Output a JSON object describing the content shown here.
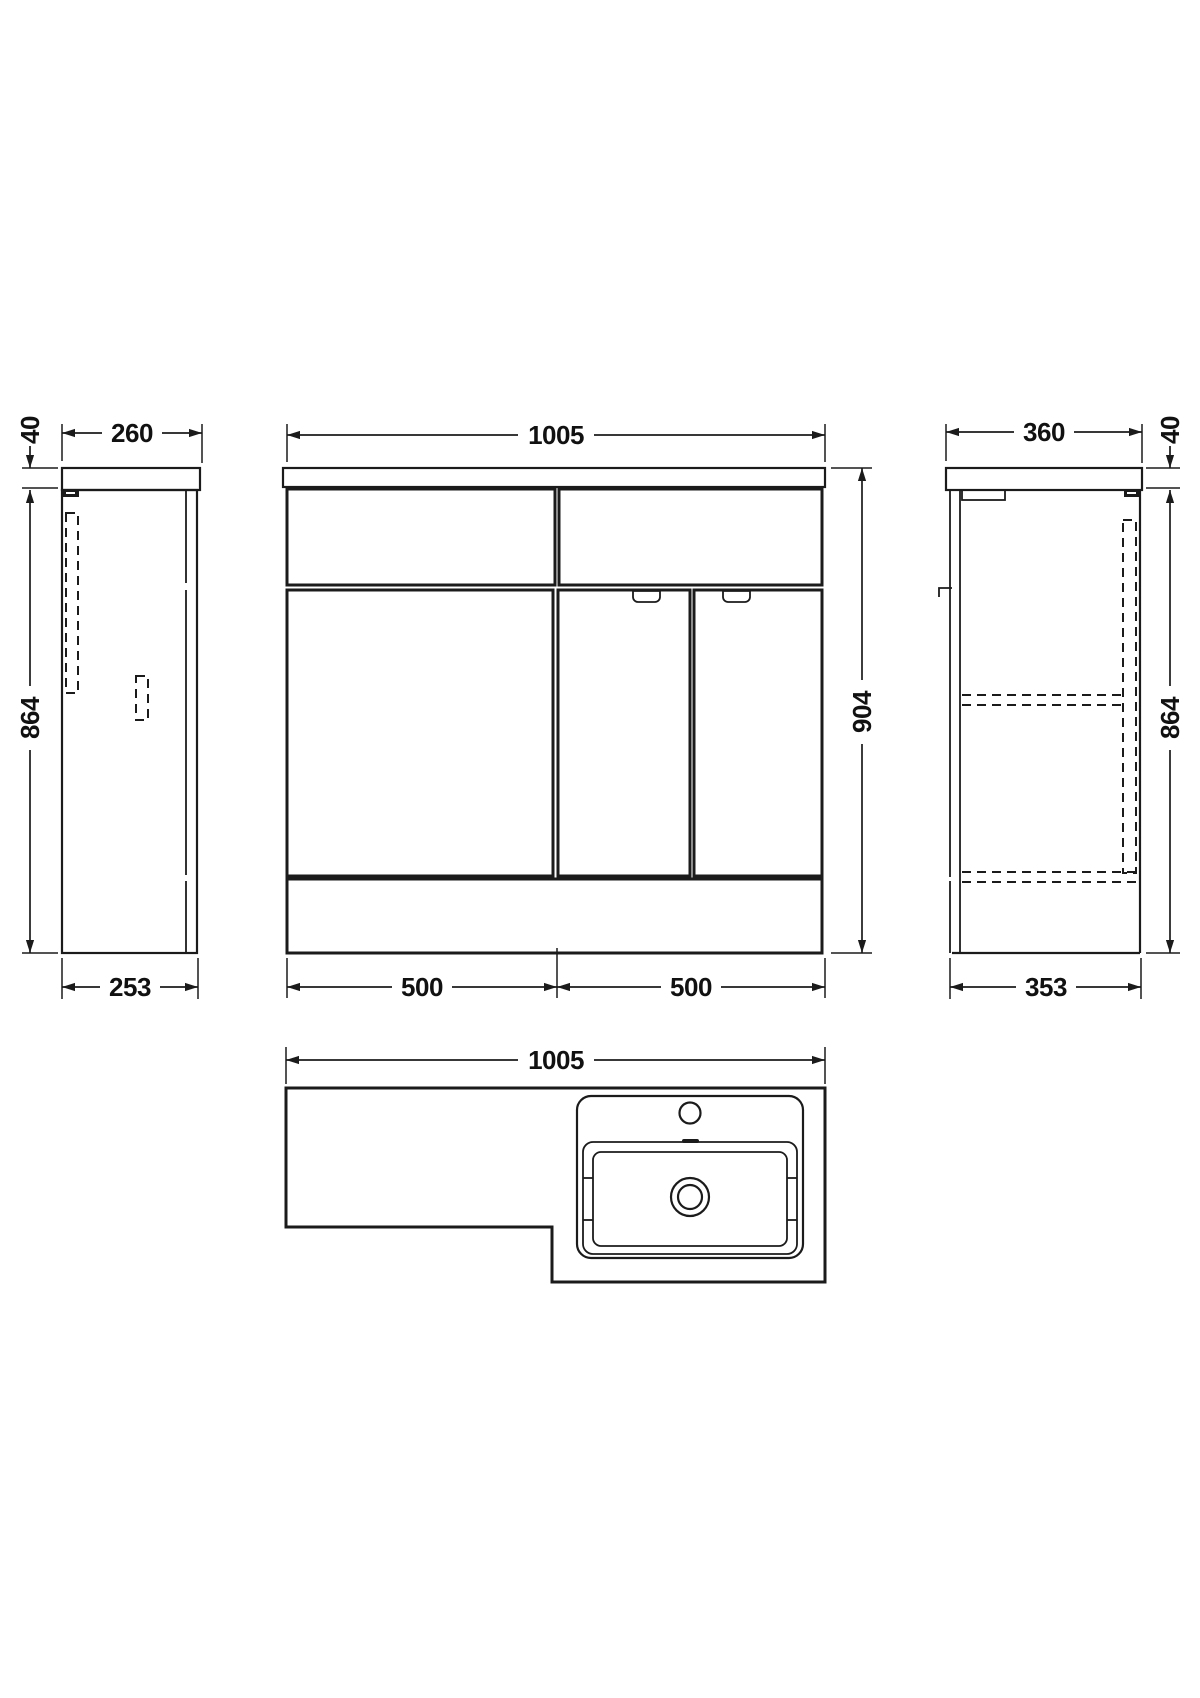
{
  "page": {
    "background": "#ffffff",
    "line_color": "#1b1b1b",
    "description": "Technical dimension drawing of combined vanity basin and WC furniture unit, four orthographic views"
  },
  "views": {
    "side_left": {
      "name": "left-end-view",
      "dim_top_thickness": "40",
      "dim_top_depth": "260",
      "dim_height": "864",
      "dim_base_depth": "253"
    },
    "front": {
      "name": "front-view",
      "dim_width": "1005",
      "dim_height": "904",
      "dim_left_width": "500",
      "dim_right_width": "500"
    },
    "side_right": {
      "name": "right-end-view",
      "dim_top_depth": "360",
      "dim_top_thickness": "40",
      "dim_height": "864",
      "dim_base_depth": "353"
    },
    "plan": {
      "name": "plan-view",
      "dim_width": "1005"
    }
  }
}
